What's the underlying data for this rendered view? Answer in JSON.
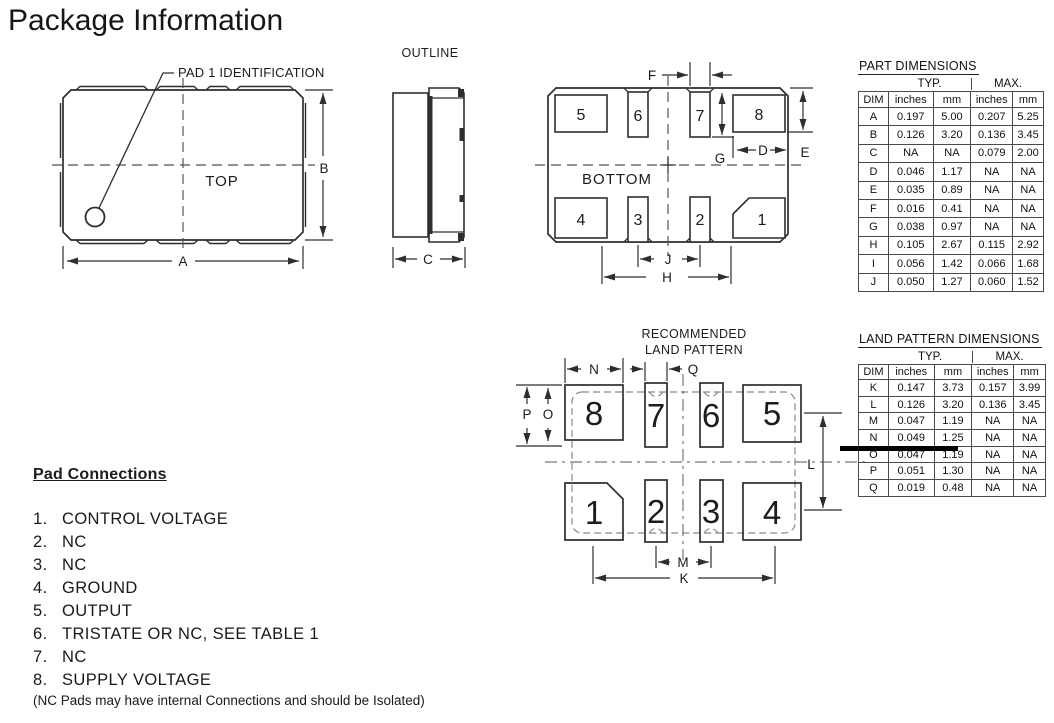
{
  "page": {
    "title": "Package Information"
  },
  "top_view": {
    "label": "TOP",
    "callout": "PAD 1 IDENTIFICATION",
    "dims": {
      "a": "A",
      "b": "B"
    }
  },
  "outline_view": {
    "title": "OUTLINE",
    "dims": {
      "c": "C"
    }
  },
  "bottom_view": {
    "label": "BOTTOM",
    "pads": [
      "5",
      "6",
      "7",
      "8",
      "4",
      "3",
      "2",
      "1"
    ],
    "dims": {
      "d": "D",
      "e": "E",
      "f": "F",
      "g": "G",
      "h": "H",
      "j": "J"
    }
  },
  "land_pattern": {
    "title_line1": "RECOMMENDED",
    "title_line2": "LAND PATTERN",
    "pads": [
      "8",
      "7",
      "6",
      "5",
      "1",
      "2",
      "3",
      "4"
    ],
    "dims": {
      "k": "K",
      "l": "L",
      "m": "M",
      "n": "N",
      "o": "O",
      "p": "P",
      "q": "Q"
    }
  },
  "part_table": {
    "title": "PART DIMENSIONS",
    "group_headers": [
      "TYP.",
      "MAX."
    ],
    "col_headers": [
      "DIM",
      "inches",
      "mm",
      "inches",
      "mm"
    ],
    "rows": [
      {
        "dim": "A",
        "typ_in": "0.197",
        "typ_mm": "5.00",
        "max_in": "0.207",
        "max_mm": "5.25"
      },
      {
        "dim": "B",
        "typ_in": "0.126",
        "typ_mm": "3.20",
        "max_in": "0.136",
        "max_mm": "3.45"
      },
      {
        "dim": "C",
        "typ_in": "NA",
        "typ_mm": "NA",
        "max_in": "0.079",
        "max_mm": "2.00"
      },
      {
        "dim": "D",
        "typ_in": "0.046",
        "typ_mm": "1.17",
        "max_in": "NA",
        "max_mm": "NA"
      },
      {
        "dim": "E",
        "typ_in": "0.035",
        "typ_mm": "0.89",
        "max_in": "NA",
        "max_mm": "NA"
      },
      {
        "dim": "F",
        "typ_in": "0.016",
        "typ_mm": "0.41",
        "max_in": "NA",
        "max_mm": "NA"
      },
      {
        "dim": "G",
        "typ_in": "0.038",
        "typ_mm": "0.97",
        "max_in": "NA",
        "max_mm": "NA"
      },
      {
        "dim": "H",
        "typ_in": "0.105",
        "typ_mm": "2.67",
        "max_in": "0.115",
        "max_mm": "2.92"
      },
      {
        "dim": "I",
        "typ_in": "0.056",
        "typ_mm": "1.42",
        "max_in": "0.066",
        "max_mm": "1.68"
      },
      {
        "dim": "J",
        "typ_in": "0.050",
        "typ_mm": "1.27",
        "max_in": "0.060",
        "max_mm": "1.52"
      }
    ]
  },
  "land_table": {
    "title": "LAND PATTERN DIMENSIONS",
    "group_headers": [
      "TYP.",
      "MAX."
    ],
    "col_headers": [
      "DIM",
      "inches",
      "mm",
      "inches",
      "mm"
    ],
    "rows": [
      {
        "dim": "K",
        "typ_in": "0.147",
        "typ_mm": "3.73",
        "max_in": "0.157",
        "max_mm": "3.99"
      },
      {
        "dim": "L",
        "typ_in": "0.126",
        "typ_mm": "3.20",
        "max_in": "0.136",
        "max_mm": "3.45"
      },
      {
        "dim": "M",
        "typ_in": "0.047",
        "typ_mm": "1.19",
        "max_in": "NA",
        "max_mm": "NA"
      },
      {
        "dim": "N",
        "typ_in": "0.049",
        "typ_mm": "1.25",
        "max_in": "NA",
        "max_mm": "NA"
      },
      {
        "dim": "O",
        "typ_in": "0.047",
        "typ_mm": "1.19",
        "max_in": "NA",
        "max_mm": "NA"
      },
      {
        "dim": "P",
        "typ_in": "0.051",
        "typ_mm": "1.30",
        "max_in": "NA",
        "max_mm": "NA"
      },
      {
        "dim": "Q",
        "typ_in": "0.019",
        "typ_mm": "0.48",
        "max_in": "NA",
        "max_mm": "NA"
      }
    ]
  },
  "pad_connections": {
    "title": "Pad Connections",
    "items": [
      {
        "num": "1.",
        "label": "CONTROL VOLTAGE"
      },
      {
        "num": "2.",
        "label": "NC"
      },
      {
        "num": "3.",
        "label": "NC"
      },
      {
        "num": "4.",
        "label": "GROUND"
      },
      {
        "num": "5.",
        "label": "OUTPUT"
      },
      {
        "num": "6.",
        "label": "TRISTATE OR NC, SEE TABLE 1"
      },
      {
        "num": "7.",
        "label": "NC"
      },
      {
        "num": "8.",
        "label": "SUPPLY VOLTAGE"
      }
    ],
    "note": "(NC Pads may have internal Connections and should be Isolated)"
  }
}
